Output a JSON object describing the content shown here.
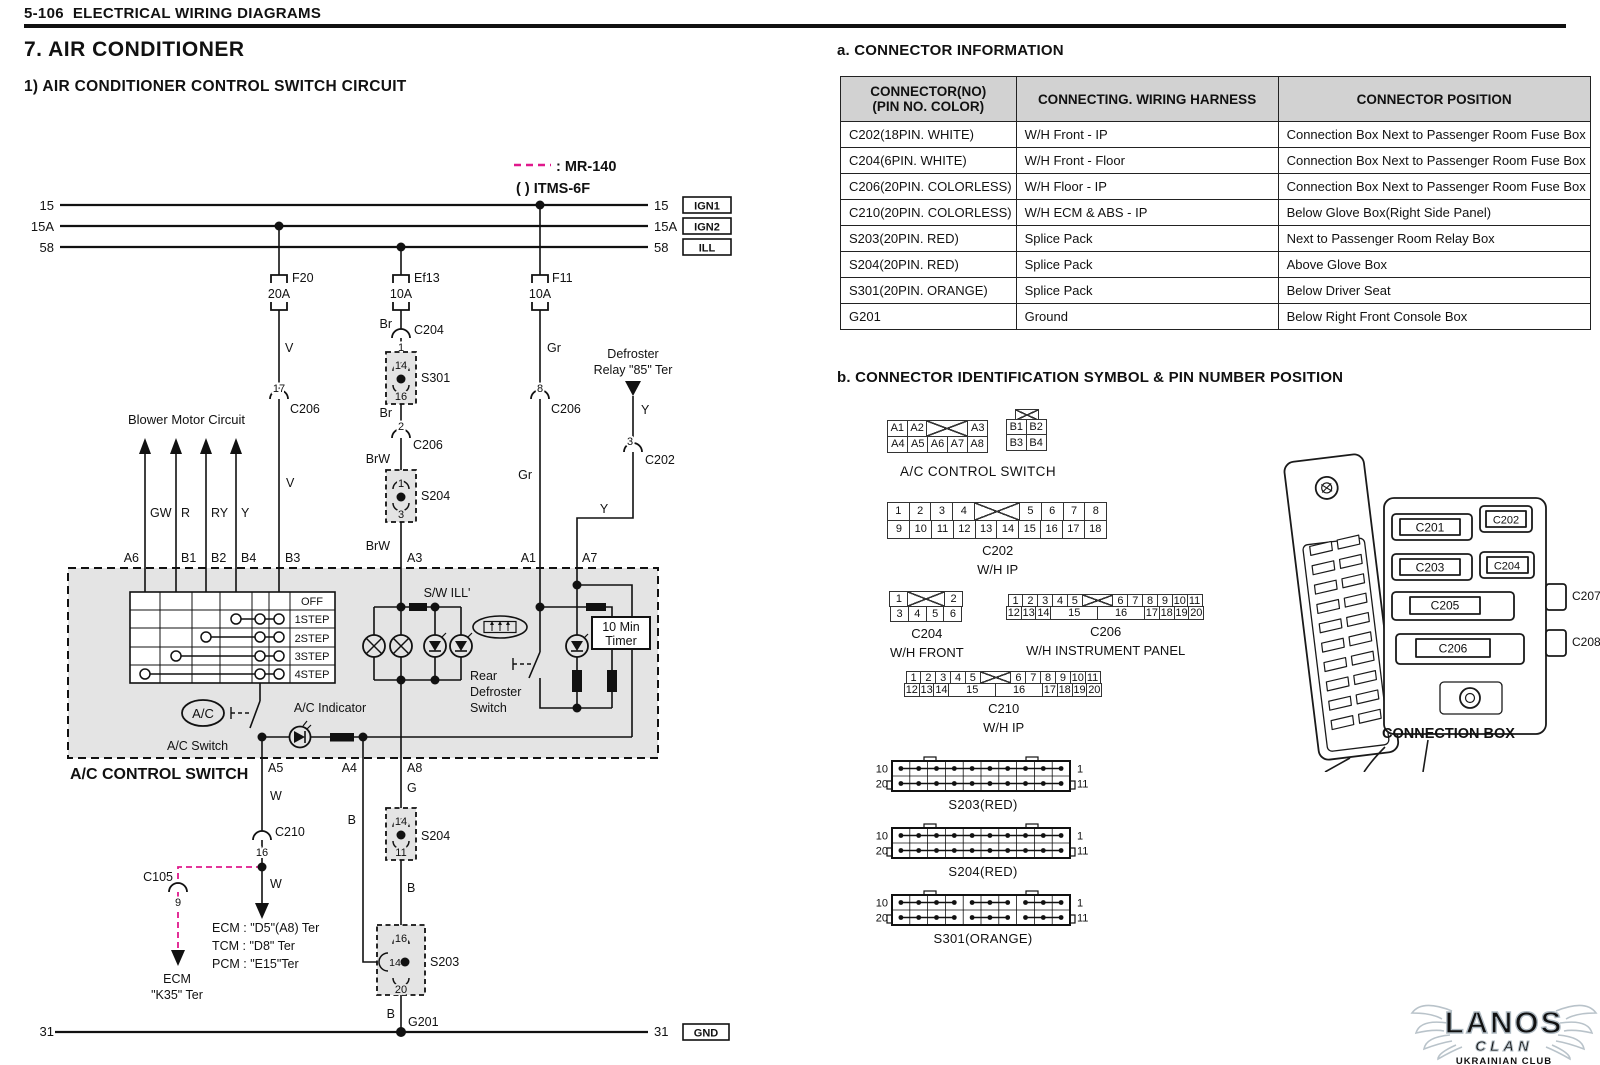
{
  "page": {
    "code": "5-106",
    "title": "ELECTRICAL WIRING DIAGRAMS",
    "section": "7.  AIR CONDITIONER",
    "subsection": "1)  AIR CONDITIONER CONTROL SWITCH CIRCUIT"
  },
  "legend": {
    "dash_label": ": MR-140",
    "paren_label": "(   ) ITMS-6F"
  },
  "bus": {
    "l15": "15",
    "l15a": "15A",
    "l58": "58",
    "l31": "31",
    "r15": "15",
    "r15a": "15A",
    "r58": "58",
    "r31": "31",
    "ign1": "IGN1",
    "ign2": "IGN2",
    "ill": "ILL",
    "gnd": "GND"
  },
  "fuses": {
    "f20": {
      "name": "F20",
      "amp": "20A"
    },
    "ef13": {
      "name": "Ef13",
      "amp": "10A"
    },
    "f11": {
      "name": "F11",
      "amp": "10A"
    }
  },
  "wires": {
    "v1": "V",
    "v2": "V",
    "br1": "Br",
    "br2": "Br",
    "brw1": "BrW",
    "brw2": "BrW",
    "gr1": "Gr",
    "gr2": "Gr",
    "y1": "Y",
    "y2": "Y",
    "gw": "GW",
    "r": "R",
    "ry": "RY",
    "yb": "Y",
    "w1": "W",
    "w2": "W",
    "g": "G",
    "b_a4": "B",
    "b1": "B",
    "b2": "B",
    "b3": "B"
  },
  "conn_pins": {
    "c206_17": {
      "no": "17",
      "name": "C206"
    },
    "c204_1": {
      "no": "1",
      "name": "C204"
    },
    "c206_2": {
      "no": "2",
      "name": "C206"
    },
    "c206_8": {
      "no": "8",
      "name": "C206"
    },
    "c202_3": {
      "no": "3",
      "name": "C202"
    },
    "c210_16": {
      "no": "16",
      "name": "C210"
    },
    "c105_9": {
      "no": "9",
      "name": "C105"
    }
  },
  "splices": {
    "s301": {
      "name": "S301",
      "top": "14",
      "bottom": "16"
    },
    "s204_upper": {
      "name": "S204",
      "top": "1",
      "bottom": "3"
    },
    "s204_lower": {
      "name": "S204",
      "top": "14",
      "bottom": "11"
    },
    "s203": {
      "name": "S203",
      "top": "16",
      "left": "14",
      "bottom": "20"
    }
  },
  "labels": {
    "blower": "Blower Motor Circuit",
    "defroster_relay_1": "Defroster",
    "defroster_relay_2": "Relay \"85\" Ter",
    "sw_ill": "S/W ILL'",
    "rear_def_1": "Rear",
    "rear_def_2": "Defroster",
    "rear_def_3": "Switch",
    "timer_1": "10 Min",
    "timer_2": "Timer",
    "ac": "A/C",
    "ac_switch": "A/C Switch",
    "ac_indicator": "A/C Indicator",
    "box_title": "A/C CONTROL SWITCH",
    "g201": "G201",
    "ecm_d5": "ECM : \"D5\"(A8) Ter",
    "tcm_d8": "TCM : \"D8\" Ter",
    "pcm_e15": "PCM : \"E15\"Ter",
    "ecm": "ECM",
    "k35": "\"K35\" Ter"
  },
  "steps": [
    "OFF",
    "1STEP",
    "2STEP",
    "3STEP",
    "4STEP"
  ],
  "pin_ids": {
    "a6": "A6",
    "b1": "B1",
    "b2": "B2",
    "b4": "B4",
    "b3": "B3",
    "a3": "A3",
    "a1": "A1",
    "a7": "A7",
    "a5": "A5",
    "a4": "A4",
    "a8": "A8"
  },
  "section_a": {
    "title": "a. CONNECTOR INFORMATION",
    "headers": [
      "CONNECTOR(NO)",
      "(PIN NO. COLOR)",
      "CONNECTING. WIRING HARNESS",
      "CONNECTOR POSITION"
    ],
    "rows": [
      [
        "C202(18PIN. WHITE)",
        "W/H Front - IP",
        "Connection Box Next to Passenger Room Fuse Box"
      ],
      [
        "C204(6PIN. WHITE)",
        "W/H Front - Floor",
        "Connection Box Next to Passenger Room Fuse Box"
      ],
      [
        "C206(20PIN. COLORLESS)",
        "W/H Floor - IP",
        "Connection Box Next to Passenger Room Fuse Box"
      ],
      [
        "C210(20PIN. COLORLESS)",
        "W/H ECM & ABS - IP",
        "Below Glove Box(Right Side Panel)"
      ],
      [
        "S203(20PIN. RED)",
        "Splice Pack",
        "Next to Passenger Room Relay Box"
      ],
      [
        "S204(20PIN. RED)",
        "Splice Pack",
        "Above Glove Box"
      ],
      [
        "S301(20PIN. ORANGE)",
        "Splice Pack",
        "Below Driver Seat"
      ],
      [
        "G201",
        "Ground",
        "Below Right Front Console Box"
      ]
    ]
  },
  "section_b": {
    "title": "b. CONNECTOR IDENTIFICATION SYMBOL & PIN NUMBER POSITION",
    "ac_switch_caption": "A/C CONTROL SWITCH",
    "grids": [
      {
        "id": "ac-a",
        "x": 888,
        "y": 421,
        "cw": 21,
        "ch": 17,
        "rows": [
          [
            {
              "t": "A1"
            },
            {
              "t": "A2"
            },
            {
              "x": 1,
              "s": 2
            },
            {
              "t": "A3"
            }
          ],
          [
            {
              "t": "A4"
            },
            {
              "t": "A5"
            },
            {
              "t": "A6"
            },
            {
              "t": "A7"
            },
            {
              "t": "A8"
            }
          ]
        ],
        "labels": []
      },
      {
        "id": "ac-b",
        "x": 1007,
        "y": 409,
        "cw": 21,
        "ch": 17,
        "topx": 1,
        "rows": [
          [
            {
              "t": "B1"
            },
            {
              "t": "B2"
            }
          ],
          [
            {
              "t": "B3"
            },
            {
              "t": "B4"
            }
          ]
        ],
        "labels": []
      },
      {
        "id": "c202",
        "x": 888,
        "y": 503,
        "cw": 23,
        "ch": 19,
        "rows": [
          [
            {
              "t": "1"
            },
            {
              "t": "2"
            },
            {
              "t": "3"
            },
            {
              "t": "4"
            },
            {
              "x": 1,
              "s": 2
            },
            {
              "t": "5"
            },
            {
              "t": "6"
            },
            {
              "t": "7"
            },
            {
              "t": "8"
            }
          ],
          [
            {
              "t": "9"
            },
            {
              "t": "10"
            },
            {
              "t": "11"
            },
            {
              "t": "12"
            },
            {
              "t": "13"
            },
            {
              "t": "14"
            },
            {
              "t": "15"
            },
            {
              "t": "16"
            },
            {
              "t": "17"
            },
            {
              "t": "18"
            }
          ]
        ],
        "labels": [
          "C202",
          "W/H IP"
        ]
      },
      {
        "id": "c204",
        "x": 890,
        "y": 592,
        "cw": 19,
        "ch": 16,
        "rows": [
          [
            {
              "t": "1"
            },
            {
              "x": 1,
              "s": 2
            },
            {
              "t": "2"
            }
          ],
          [
            {
              "t": "3"
            },
            {
              "t": "4"
            },
            {
              "t": "5"
            },
            {
              "t": "6"
            }
          ]
        ],
        "labels": [
          "C204",
          "W/H FRONT"
        ]
      },
      {
        "id": "c206",
        "x": 1007,
        "y": 595,
        "cw": 16,
        "ch": 13.5,
        "rows": [
          [
            {
              "t": "1"
            },
            {
              "t": "2"
            },
            {
              "t": "3"
            },
            {
              "t": "4"
            },
            {
              "t": "5"
            },
            {
              "x": 1,
              "s": 2
            },
            {
              "t": "6"
            },
            {
              "t": "7"
            },
            {
              "t": "8"
            },
            {
              "t": "9"
            },
            {
              "t": "10"
            },
            {
              "t": "11"
            }
          ],
          [
            {
              "t": "12"
            },
            {
              "t": "13"
            },
            {
              "t": "14"
            },
            {
              "t": "15",
              "s": 3
            },
            {
              "t": "16",
              "s": 3
            },
            {
              "t": "17"
            },
            {
              "t": "18"
            },
            {
              "t": "19"
            },
            {
              "t": "20"
            }
          ]
        ],
        "labels": [
          "C206",
          "W/H INSTRUMENT PANEL"
        ]
      },
      {
        "id": "c210",
        "x": 905,
        "y": 672,
        "cw": 16,
        "ch": 13.5,
        "rows": [
          [
            {
              "t": "1"
            },
            {
              "t": "2"
            },
            {
              "t": "3"
            },
            {
              "t": "4"
            },
            {
              "t": "5"
            },
            {
              "x": 1,
              "s": 2
            },
            {
              "t": "6"
            },
            {
              "t": "7"
            },
            {
              "t": "8"
            },
            {
              "t": "9"
            },
            {
              "t": "10"
            },
            {
              "t": "11"
            }
          ],
          [
            {
              "t": "12"
            },
            {
              "t": "13"
            },
            {
              "t": "14"
            },
            {
              "t": "15",
              "s": 3
            },
            {
              "t": "16",
              "s": 3
            },
            {
              "t": "17"
            },
            {
              "t": "18"
            },
            {
              "t": "19"
            },
            {
              "t": "20"
            }
          ]
        ],
        "labels": [
          "C210",
          "W/H IP"
        ]
      }
    ],
    "packs": [
      {
        "name": "S203(RED)",
        "x": 868,
        "y": 756,
        "groups": [
          10
        ]
      },
      {
        "name": "S204(RED)",
        "x": 868,
        "y": 823,
        "groups": [
          10
        ]
      },
      {
        "name": "S301(ORANGE)",
        "x": 868,
        "y": 890,
        "groups": [
          4,
          3,
          3
        ]
      }
    ],
    "pack_pins": {
      "tl": "10",
      "bl": "20",
      "tr": "1",
      "br": "11"
    }
  },
  "connection_box": {
    "caption": "CONNECTION BOX",
    "c201": "C201",
    "c202": "C202",
    "c203": "C203",
    "c204": "C204",
    "c205": "C205",
    "c206": "C206",
    "c207": "C207",
    "c208": "C208"
  },
  "watermark": {
    "name": "LANOS",
    "sub": "CLAN",
    "club": "UKRAINIAN CLUB"
  },
  "colors": {
    "magenta": "#e0188c",
    "panel_gray": "#e4e4e4",
    "header_gray": "#d2d2d2",
    "watermark": "#b9c3ca"
  }
}
